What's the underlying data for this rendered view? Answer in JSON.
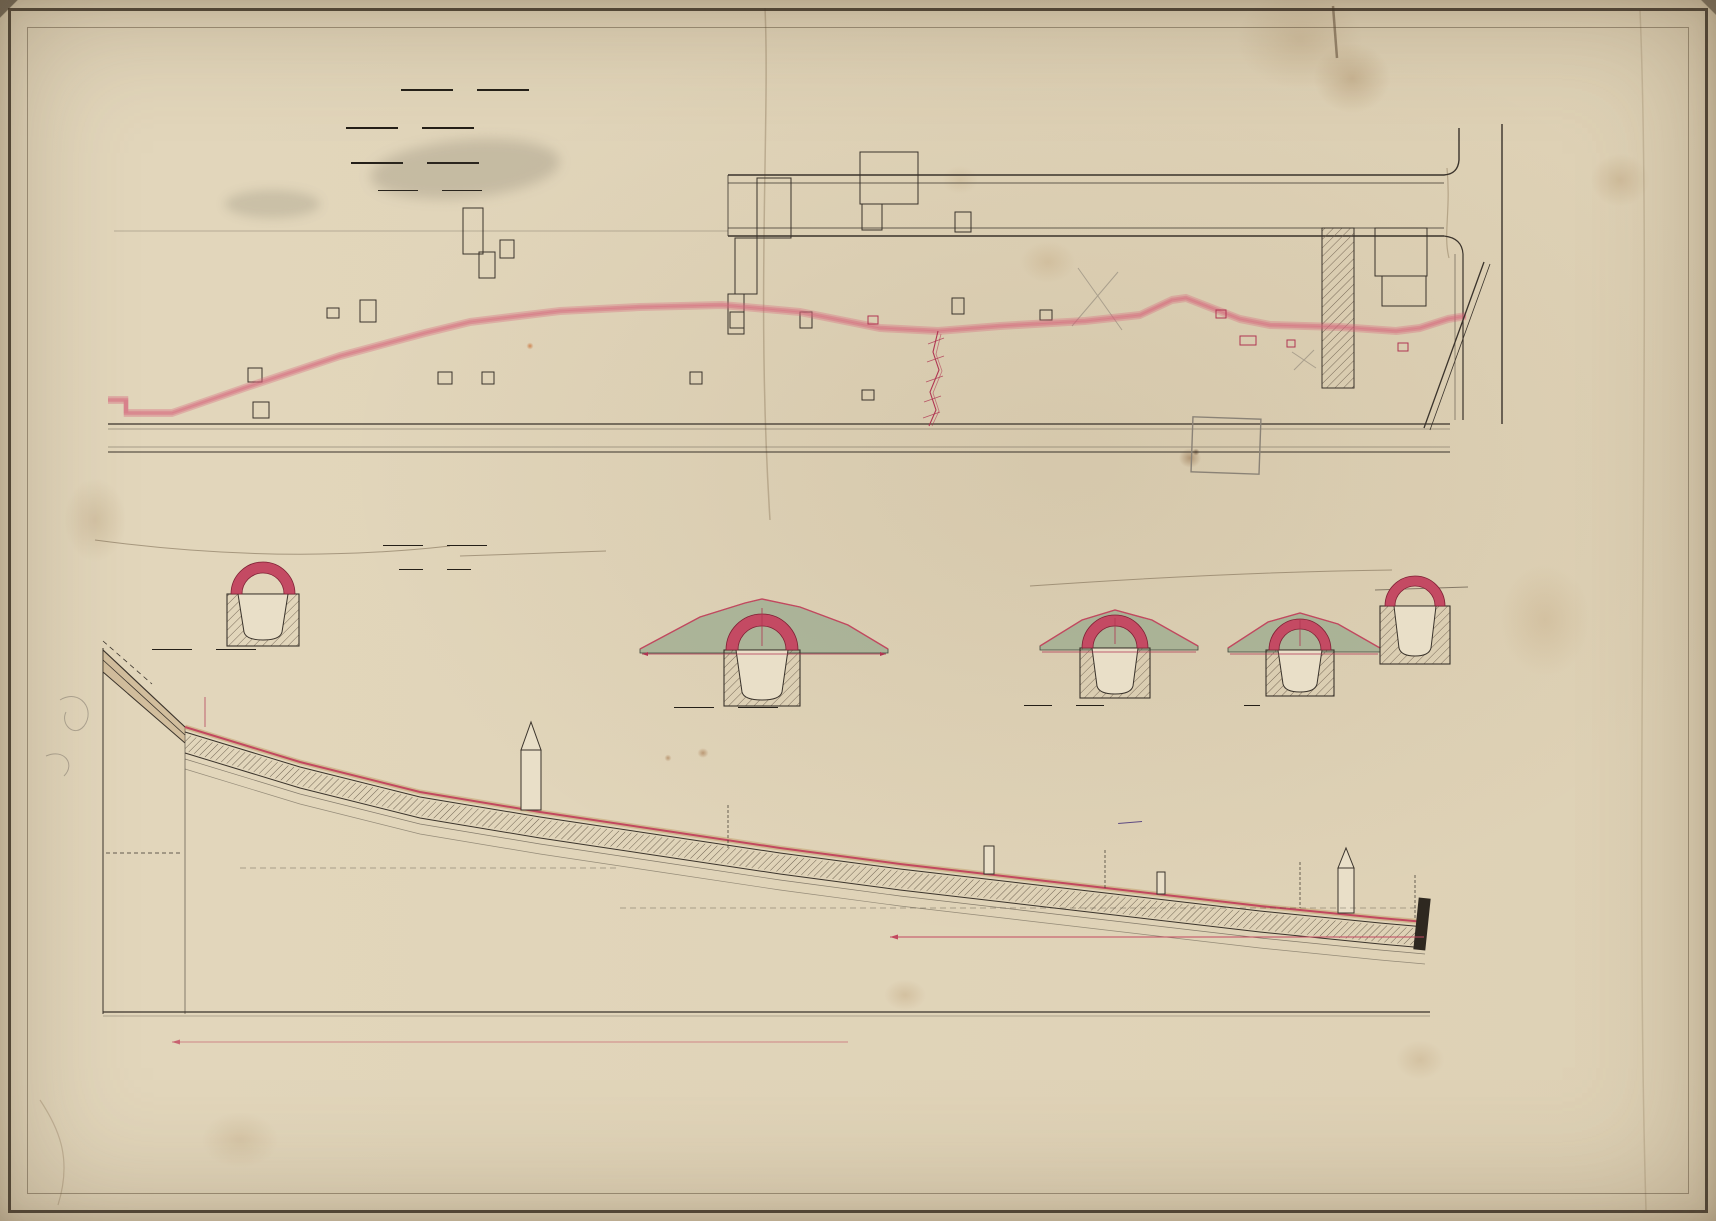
{
  "corner_ref": {
    "l1": "D",
    "l2": "3",
    "l3": "35"
  },
  "corner_ref2": {
    "l1": "D",
    "l2": "3",
    "l3": "35"
  },
  "pencil_notes": {
    "negs": "2 Negs.",
    "contract": "Contract No 30.",
    "corner_small": "2 6 4",
    "side_mark": "2 6 y",
    "cancel": "Cancel  Lane  4",
    "carrol1": "Carrol",
    "carrol2": "Lane",
    "chain": "3 Ch 7",
    "bcc": "4-BCC-"
  },
  "title": {
    "l1": "CITY  OF  BRISBANE",
    "l2": "ARCHING  OVER  OPEN  DRAIN  BETWEEN",
    "l3": "BOWEN ST.  AND  WHARF ST"
  },
  "scale_block": {
    "heading": "SCALE",
    "h_label": "HORIZONTAL",
    "h_dash": "—",
    "h_value": "33 FT. TO 1 IN.",
    "v_label": "VERTICAL",
    "v_value": "10 FT.   „    „"
  },
  "plan": {
    "street1": "BOWEN",
    "street1b": "ST.",
    "street2a": "ANN",
    "street2b": "ST.",
    "lane_words": [
      "LANE",
      "AT",
      "REAR",
      "OF",
      "WHARF",
      "ST."
    ],
    "pt_a": "A",
    "pt_b": "B",
    "pt_c": "C",
    "pt_d": "D",
    "pt_e": "E",
    "w_open": "OPEN",
    "w_stone": "STONE",
    "w_drain": "DRAIN",
    "w_tobe": "TO  BE",
    "w_arched": "ARCHED",
    "w_over": "OVER",
    "main_sewer": "MAIN  SEWER",
    "gully": "3'.0 Gully"
  },
  "sections": {
    "scale_l1": "SCALE  FOR  CROSS  SECTIONS",
    "scale_l2": "4 FEET  TO  1 IN.",
    "a": "SECTION AT A",
    "b": "SECTION AT B",
    "c": "SECTION AT C",
    "d": "SECTION AT D",
    "e": "SECTION AT E",
    "dim_a": "2'.0\"",
    "dim_b_l": "12'.0\"",
    "dim_b_c": "2'.0\"",
    "dim_b_r": "12'.0\"",
    "dim_rise": "1'.6\"",
    "dim_c_l": "6'.0\"",
    "dim_c_c": "2'.0\"",
    "dim_c_r": "6'.6\"",
    "dim_d_l": "6'.0\"",
    "dim_d_c": "2'.0\"",
    "dim_d_r": "6'.0\"",
    "dim_e": "2'.10\""
  },
  "note": {
    "l1": "Refer Plan D-3-3 For Original",
    "l2": "Stone Drain.",
    "l3": "Bb. 10/1383"
  },
  "stamp": {
    "l1_pre": "are the Drawings referred to in",
    "l1_hw": "my",
    "l2": "er accepted by the Brisbane Municipal",
    "l3_pre": "Council, the",
    "l3_day": "26th",
    "l3_mid": "day of",
    "l3_month": "July",
    "l3_year": "1897",
    "l4_pre": "Signed this",
    "l4_day": "28th",
    "l4_mid": "day of",
    "l4_month": "July",
    "l4_year": "1897",
    "sig": "W Brennan",
    "witness": "Witness to Signature:",
    "sig2": "Php. T. Waters"
  },
  "profile": {
    "lane": "LANE",
    "pt_a": "A",
    "pt_b": "B",
    "pt_c": "C",
    "pt_d": "D",
    "pt_e": "E",
    "w_open": "OPEN",
    "w_stone": "STONE",
    "w_drain": "DRAIN",
    "main_sewer": "MAIN SEWER",
    "level": "858  O",
    "note1": "18 inches above top of drain",
    "note2": "Rises from 14 ft 6 in",
    "note3": "2.0 to 1.0 fall of drain",
    "note4": "Top of drain spring in water line 5'.6\" to 8'.0\""
  },
  "datum": {
    "text1": "DATUM   50 FEET   BELOW   L.W.M.   PORT   OFFICE   GAUGE",
    "text2": "DATUM   RAISED   100 FT.",
    "sub13": "12.73",
    "stations": [
      {
        "n": "13",
        "ch": "766.09  762.91"
      },
      {
        "n": "12",
        "ch": "762.52  759.41"
      },
      {
        "n": "11",
        "ch": "758.75  755.82"
      },
      {
        "n": "10",
        "ch": "754.96  751.80"
      },
      {
        "n": "9",
        "ch": "750.32  747.04"
      },
      {
        "n": "8",
        "ch": "746.98  743.08"
      },
      {
        "n": "7",
        "ch": "742.56  739.16"
      },
      {
        "n": "6",
        "ch": "738.04  734.91"
      },
      {
        "n": "5",
        "ch": "734.48  731.40"
      },
      {
        "n": "4",
        "ch": "730.11  727.35"
      },
      {
        "n": "3",
        "ch": "726.63  723.52"
      },
      {
        "n": "2",
        "ch": "722.17  719.44"
      },
      {
        "n": "1",
        "ch": "718.45  715.80"
      },
      {
        "n": "",
        "ch": "714.52  711.90"
      }
    ]
  }
}
